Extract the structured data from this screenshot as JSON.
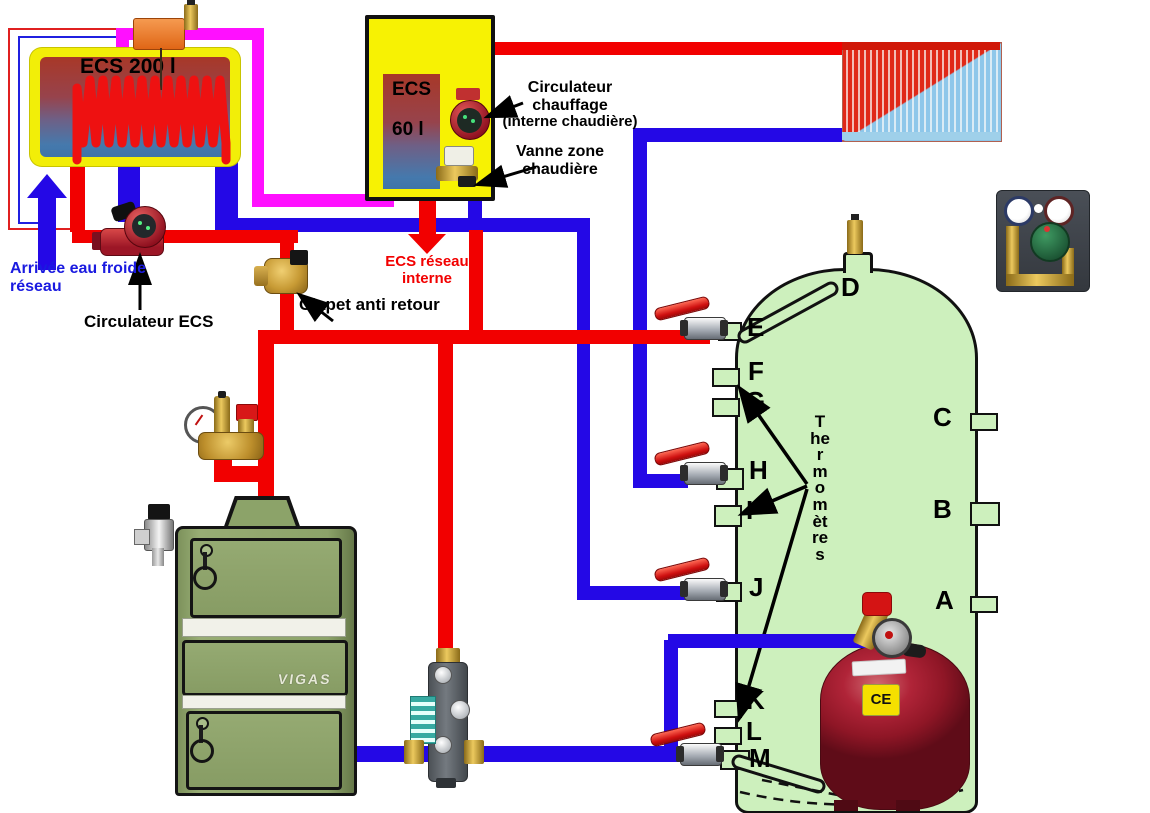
{
  "diagram": {
    "tanks": {
      "ecs200_label": "ECS 200 l",
      "ecs60_label_1": "ECS",
      "ecs60_label_2": "60 l"
    },
    "annotations": {
      "cold_water_1": "Arrivée eau froide",
      "cold_water_2": "réseau",
      "circulateur_ecs": "Circulateur ECS",
      "clapet": "Clapet anti retour",
      "circ_chauffage_1": "Circulateur",
      "circ_chauffage_2": "chauffage",
      "circ_chauffage_3": "(interne chaudière)",
      "vanne_zone_1": "Vanne zone",
      "vanne_zone_2": "chaudière",
      "ecs_reseau_1": "ECS réseau",
      "ecs_reseau_2": "interne",
      "thermometres": "Thermomètres"
    },
    "boiler": {
      "brand": "VIGAS"
    },
    "vessel": {
      "ce_mark": "CE"
    },
    "ports": {
      "A": "A",
      "B": "B",
      "C": "C",
      "D": "D",
      "E": "E",
      "F": "F",
      "G": "G",
      "H": "H",
      "I": "I",
      "J": "J",
      "K": "K",
      "L": "L",
      "M": "M"
    },
    "colors": {
      "hot_pipe": "#f20000",
      "cold_pipe": "#2408e6",
      "boiler_loop_pipe": "#ff10ff",
      "buffer_tank_fill": "#cdf0bd",
      "chaudiere_fill": "#f7f203",
      "boiler_body": "#8ca369",
      "vessel_body": "#8f1626"
    }
  }
}
